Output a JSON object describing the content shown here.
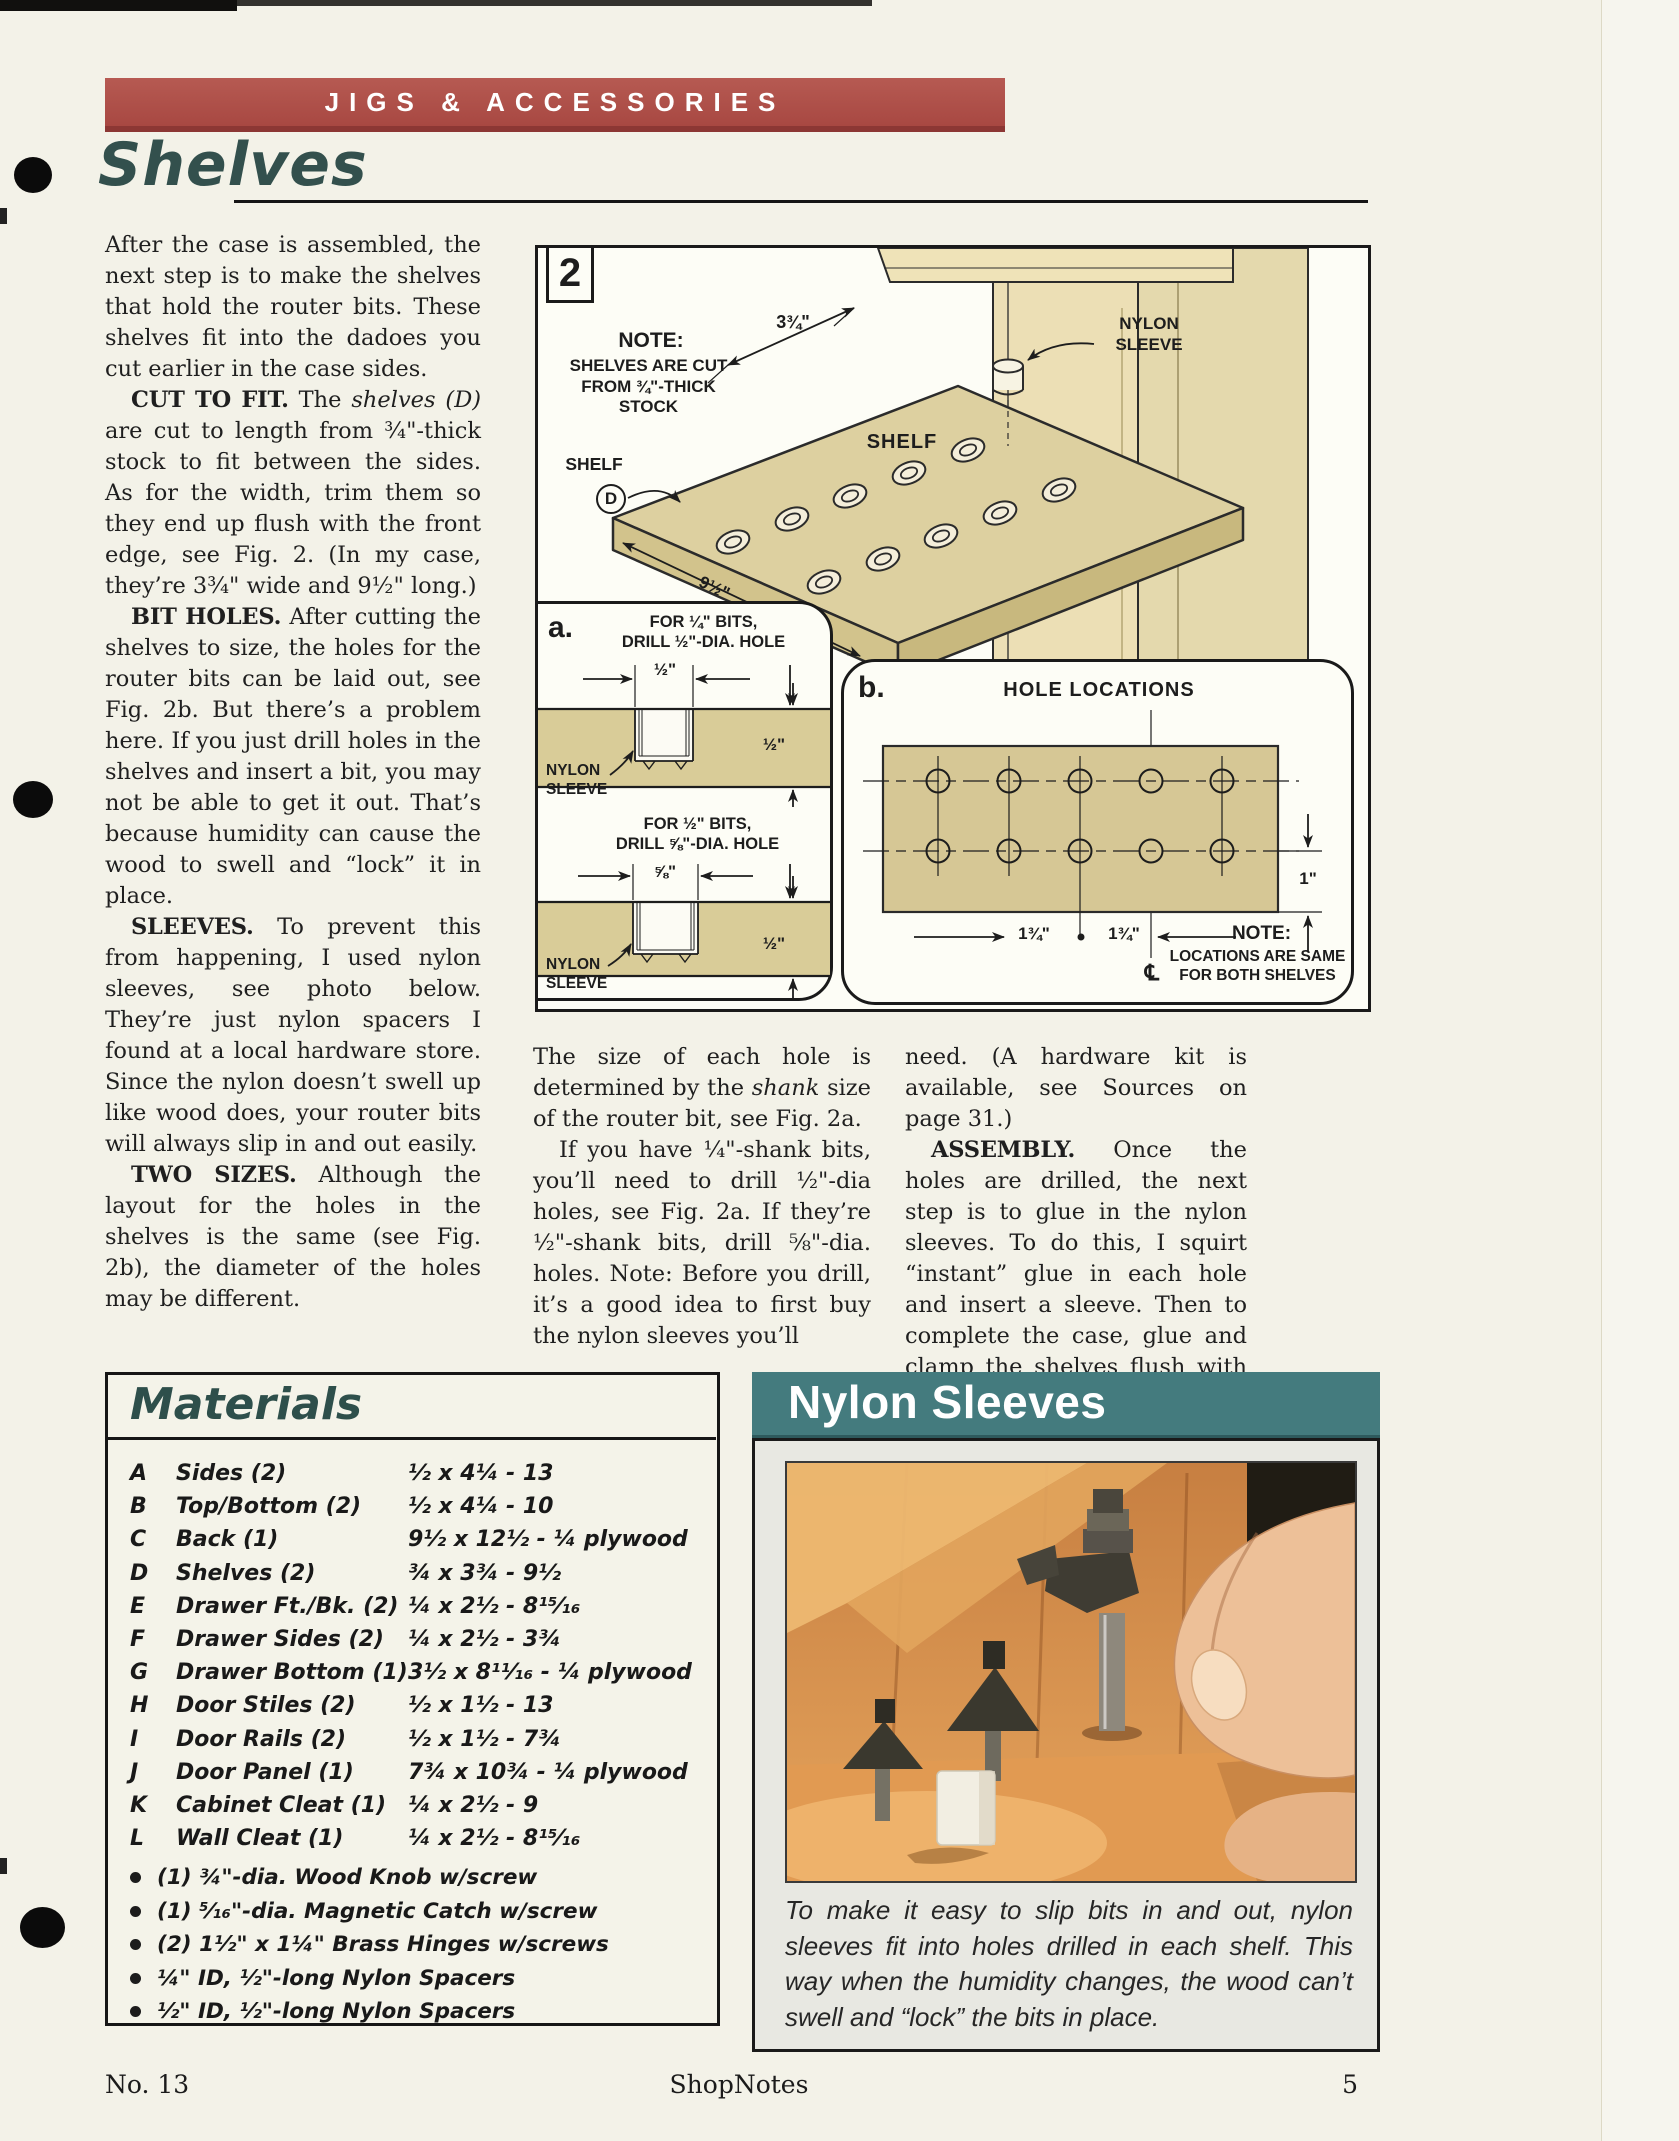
{
  "header": {
    "banner": "JIGS & ACCESSORIES",
    "title": "Shelves"
  },
  "article": {
    "col1": [
      "After the case is assembled, the next step is to make the shelves that hold the router bits. These shelves fit into the dadoes you cut earlier in the case sides.",
      "<b>CUT TO FIT.</b> The <i>shelves (D)</i> are cut to length from ¾\"-thick stock to fit between the sides. As for the width, trim them so they end up flush with the front edge, see Fig. 2. (In my case, they’re 3¾\" wide and 9½\" long.)",
      "<b>BIT HOLES.</b> After cutting the shelves to size, the holes for the router bits can be laid out, see Fig. 2b. But there’s a problem here. If you just drill holes in the shelves and insert a bit, you may not be able to get it out. That’s because humidity can cause the wood to swell and “lock” it in place.",
      "<b>SLEEVES.</b> To prevent this from happening, I used nylon sleeves, see photo below. They’re just nylon spacers I found at a local hardware store. Since the nylon doesn’t swell up like wood does, your router bits will always slip in and out easily.",
      "<b>TWO SIZES.</b> Although the layout for the holes in the shelves is the same (see Fig. 2b), the diameter of the holes may be different."
    ],
    "col2": [
      "The size of each hole is determined by the <i>shank</i> size of the router bit, see Fig. 2a.",
      "If you have ¼\"-shank bits, you’ll need to drill ½\"-dia holes, see Fig. 2a. If they’re ½\"-shank bits, drill ⅝\"-dia. holes. Note: Before you drill, it’s a good idea to first buy the nylon sleeves you’ll"
    ],
    "col3": [
      "need. (A hardware kit is available, see Sources on page 31.)",
      "<b>ASSEMBLY.</b> Once the holes are drilled, the next step is to glue in the nylon sleeves. To do this, I squirt “instant” glue in each hole and insert a sleeve. Then to complete the case, glue and clamp the shelves flush with the front edge."
    ]
  },
  "figure2": {
    "number": "2",
    "note_title": "NOTE:",
    "note_l1": "SHELVES ARE CUT",
    "note_l2": "FROM ¾\"-THICK",
    "note_l3": "STOCK",
    "dim_width": "3¾\"",
    "dim_length": "9½\"",
    "shelf_label": "SHELF",
    "callout_label": "SHELF",
    "callout_part": "D",
    "sleeve_l1": "NYLON",
    "sleeve_l2": "SLEEVE",
    "panel_a": {
      "tag": "a.",
      "s1_l1": "FOR ¼\" BITS,",
      "s1_l2": "DRILL ½\"-DIA. HOLE",
      "s1_dim_top": "½\"",
      "s1_dim_side": "½\"",
      "s2_l1": "FOR ½\" BITS,",
      "s2_l2": "DRILL ⅝\"-DIA. HOLE",
      "s2_dim_top": "⅝\"",
      "s2_dim_side": "½\""
    },
    "panel_b": {
      "tag": "b.",
      "title": "HOLE LOCATIONS",
      "dim1": "1¾\"",
      "dim2": "1¾\"",
      "dim_edge": "1\"",
      "centerline": "℄",
      "note_title": "NOTE:",
      "note_l1": "LOCATIONS ARE SAME",
      "note_l2": "FOR BOTH SHELVES"
    }
  },
  "materials": {
    "title": "Materials",
    "rows": [
      {
        "k": "A",
        "name": "Sides (2)",
        "size": "½ x 4¼ - 13"
      },
      {
        "k": "B",
        "name": "Top/Bottom (2)",
        "size": "½ x 4¼ - 10"
      },
      {
        "k": "C",
        "name": "Back (1)",
        "size": "9½ x 12½ - ¼ plywood"
      },
      {
        "k": "D",
        "name": "Shelves (2)",
        "size": "¾ x 3¾ - 9½"
      },
      {
        "k": "E",
        "name": "Drawer Ft./Bk. (2)",
        "size": "¼ x 2½ - 8¹⁵⁄₁₆"
      },
      {
        "k": "F",
        "name": "Drawer Sides (2)",
        "size": "¼ x 2½ - 3¾"
      },
      {
        "k": "G",
        "name": "Drawer Bottom (1)",
        "size": "3½ x 8¹¹⁄₁₆ - ¼ plywood"
      },
      {
        "k": "H",
        "name": "Door Stiles (2)",
        "size": "½ x 1½ - 13"
      },
      {
        "k": "I",
        "name": "Door Rails (2)",
        "size": "½ x 1½ - 7¾"
      },
      {
        "k": "J",
        "name": "Door Panel (1)",
        "size": "7¾ x 10¾ - ¼ plywood"
      },
      {
        "k": "K",
        "name": "Cabinet Cleat (1)",
        "size": "¼ x 2½ - 9"
      },
      {
        "k": "L",
        "name": "Wall Cleat (1)",
        "size": "¼ x 2½ - 8¹⁵⁄₁₆"
      }
    ],
    "bullets": [
      "(1) ¾\"-dia. Wood Knob w/screw",
      "(1) ⁵⁄₁₆\"-dia. Magnetic Catch w/screw",
      "(2) 1½\" x 1¼\" Brass Hinges w/screws",
      "¼\" ID, ½\"-long Nylon Spacers",
      "½\" ID, ½\"-long Nylon Spacers"
    ]
  },
  "sleeves_box": {
    "title": "Nylon Sleeves",
    "caption": "To make it easy to slip bits in and out, nylon sleeves fit into holes drilled in each shelf. This way when the humidity changes, the wood can’t swell and “lock” the bits in place."
  },
  "footer": {
    "issue": "No. 13",
    "brand": "ShopNotes",
    "page": "5"
  },
  "colors": {
    "banner_red": "#ad4d47",
    "banner_red_dark": "#8c3734",
    "title_teal": "#33504d",
    "sleeves_teal": "#447b7e",
    "shelf_tan": "#ddd0a0",
    "case_tan": "#ecdfb5",
    "page_cream": "#f3f2e8"
  }
}
